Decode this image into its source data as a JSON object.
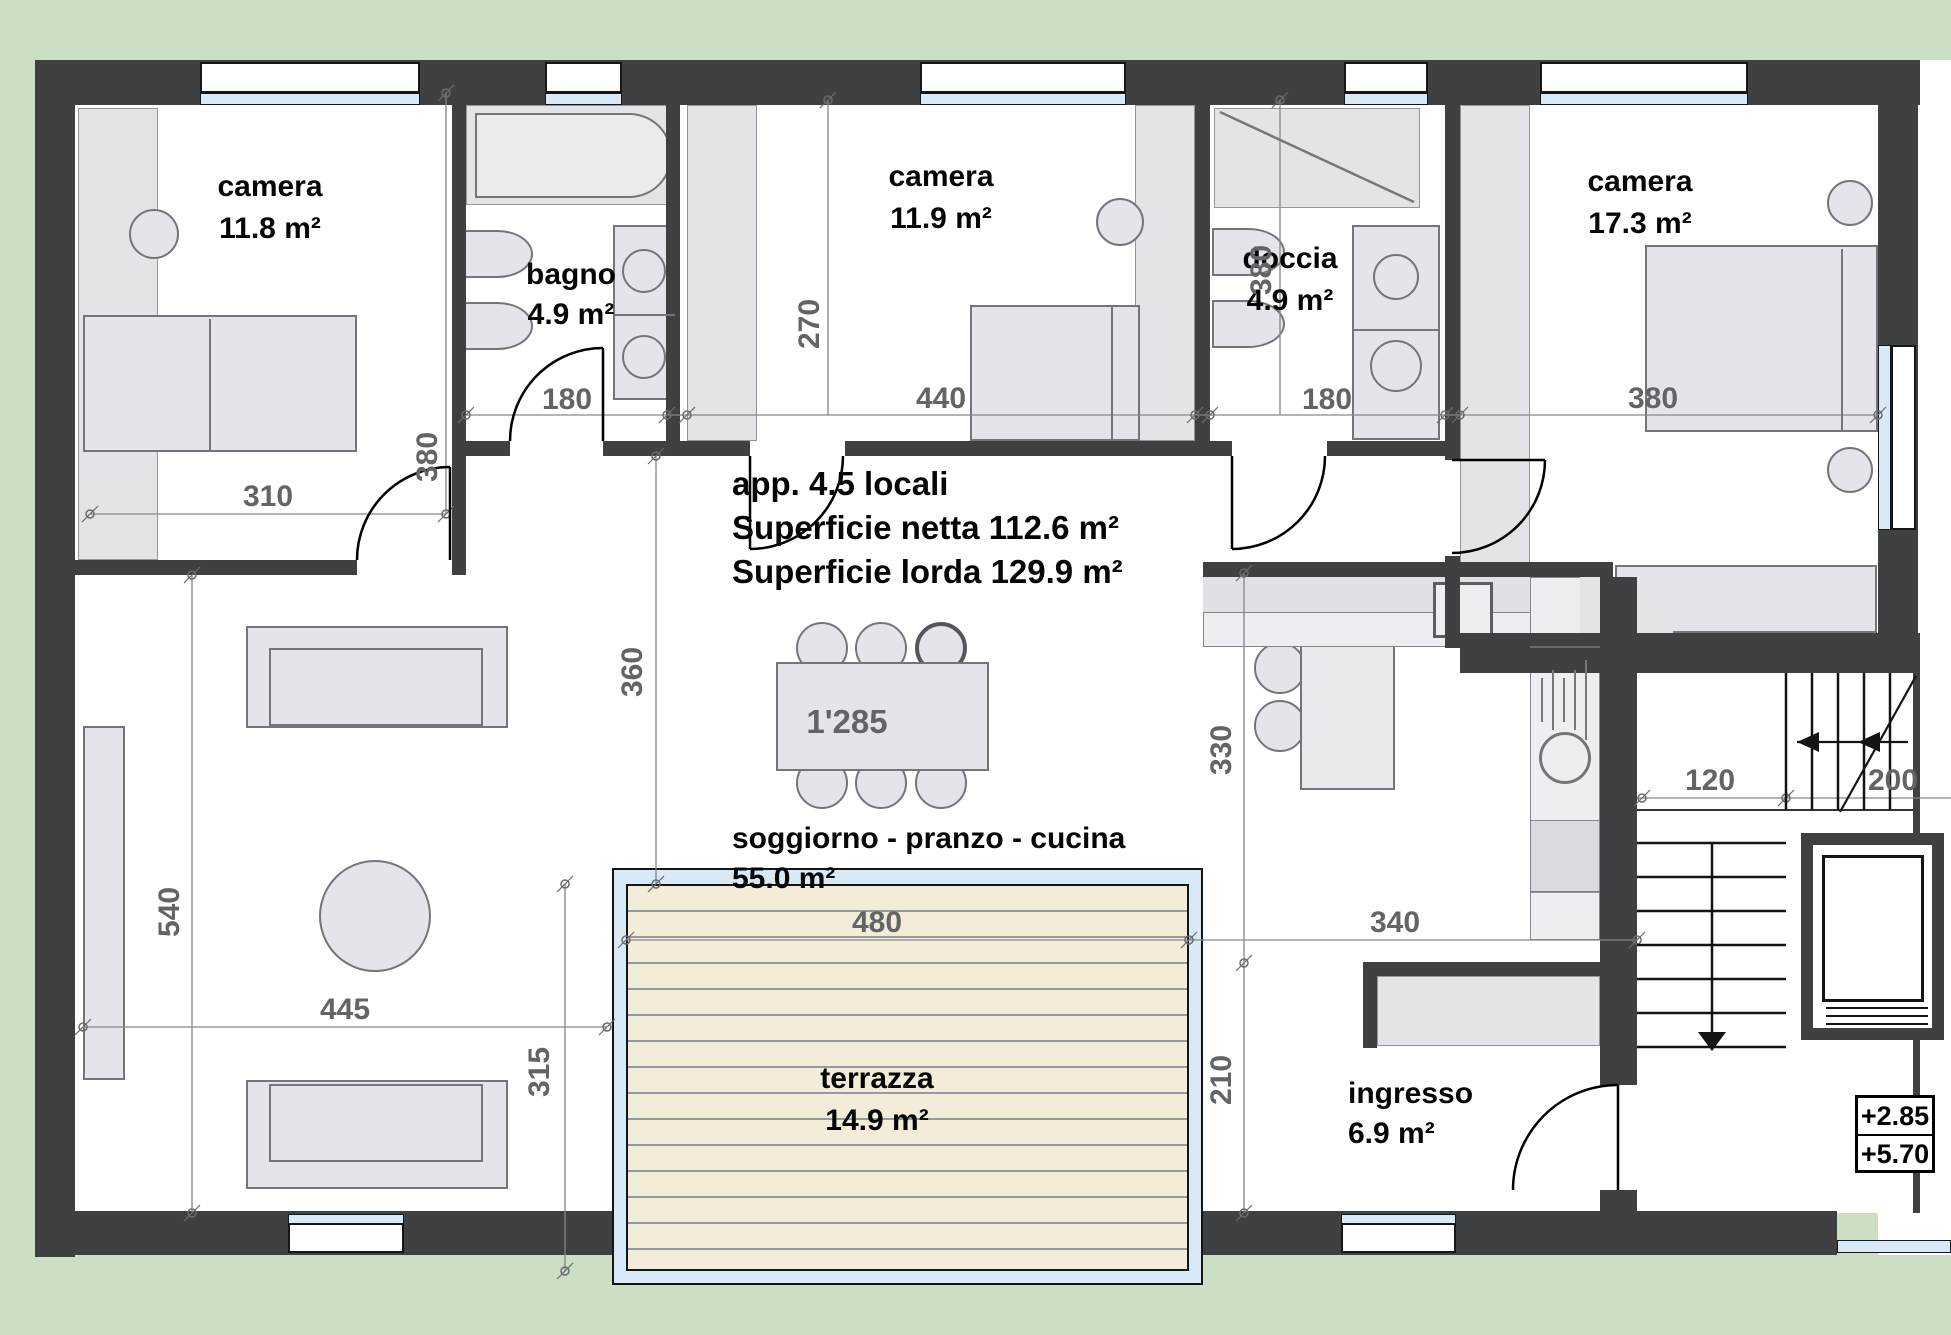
{
  "title_block": {
    "line1": "app. 4.5 locali",
    "line2": "Superficie netta 112.6 m²",
    "line3": "Superficie lorda 129.9 m²"
  },
  "rooms": {
    "camera1": {
      "name": "camera",
      "area": "11.8 m²"
    },
    "bagno": {
      "name": "bagno",
      "area": "4.9 m²"
    },
    "camera2": {
      "name": "camera",
      "area": "11.9 m²"
    },
    "doccia": {
      "name": "doccia",
      "area": "4.9 m²"
    },
    "camera3": {
      "name": "camera",
      "area": "17.3 m²"
    },
    "soggiorno": {
      "name": "soggiorno - pranzo - cucina",
      "area": "55.0 m²"
    },
    "terrazza": {
      "name": "terrazza",
      "area": "14.9 m²"
    },
    "ingresso": {
      "name": "ingresso",
      "area": "6.9 m²"
    }
  },
  "dims": {
    "camera1_w": "310",
    "camera1_h": "380",
    "bagno_w": "180",
    "camera2_w": "440",
    "camera2_h": "270",
    "doccia_w": "180",
    "camera3_w": "380",
    "camera3_h": "380",
    "soggiorno_h": "360",
    "kitchen_h": "330",
    "living_h": "540",
    "living_w": "445",
    "terrazza_w": "480",
    "terrazza_h": "315",
    "ingresso_w": "340",
    "ingresso_h": "210",
    "stair_w": "120",
    "stair_d": "200",
    "table": "1'285"
  },
  "levels": {
    "upper": "+2.85",
    "lower": "+5.70"
  },
  "colors": {
    "background": "#ccdec4",
    "wall": "#3f4042",
    "glass": "#d8e9f8",
    "deck": "#f2ecd8"
  }
}
